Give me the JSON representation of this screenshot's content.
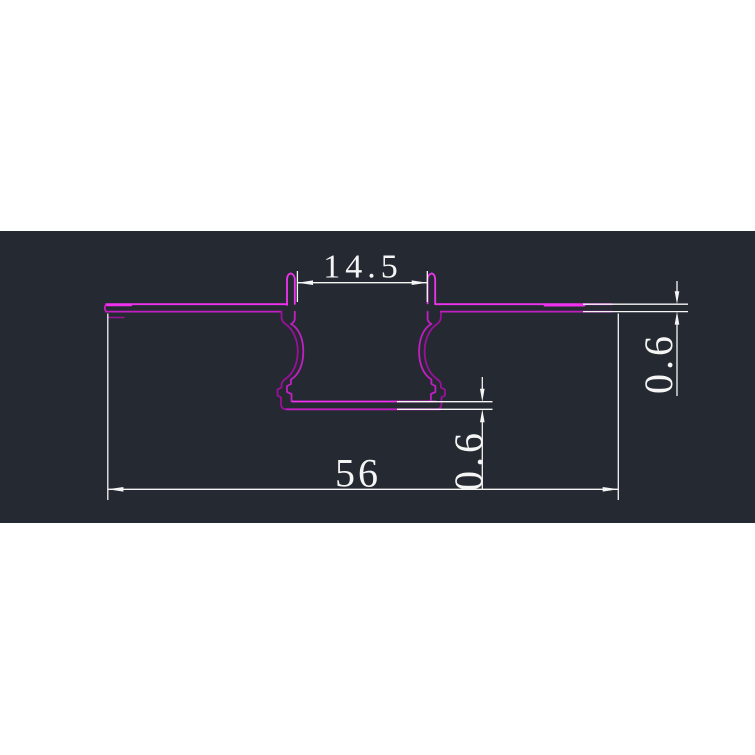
{
  "drawing": {
    "type": "cad-profile-cross-section",
    "dimensions": {
      "opening_width": "14.5",
      "overall_width": "56",
      "web_thickness": "0.6",
      "flange_thickness": "0.6"
    }
  },
  "colors": {
    "page_bg": "#ffffff",
    "panel_bg": "#252a32",
    "profile_main": "#c21fc2",
    "profile_bright": "#f032f0",
    "profile_dim": "#9a109a",
    "dim_color": "#f5f5f5"
  }
}
